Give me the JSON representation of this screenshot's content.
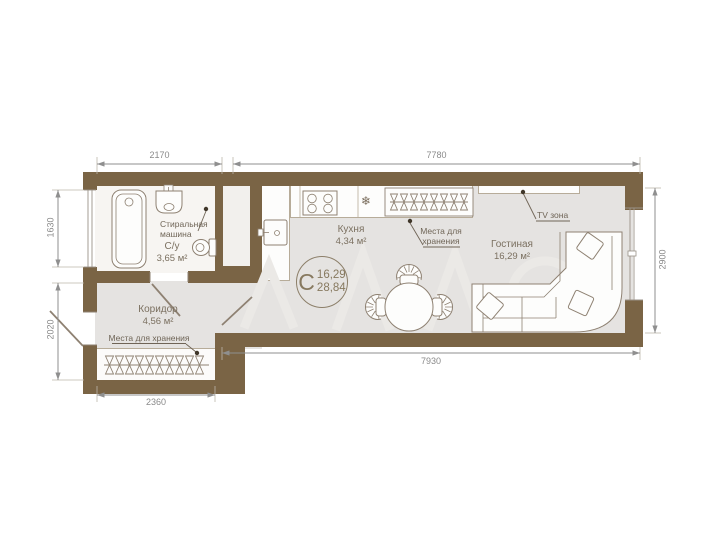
{
  "plan": {
    "badge": {
      "letter": "С",
      "area_top": "16,29",
      "area_bottom": "28,84"
    },
    "rooms": {
      "bathroom": {
        "name": "С/у",
        "area": "3,65 м²"
      },
      "washing_machine_label": "Стиральная машина",
      "kitchen": {
        "name": "Кухня",
        "area": "4,34 м²"
      },
      "kitchen_storage_label": "Места для хранения",
      "living": {
        "name": "Гостиная",
        "area": "16,29 м²"
      },
      "tv_zone_label": "TV зона",
      "corridor": {
        "name": "Коридор",
        "area": "4,56 м²"
      },
      "corridor_storage_label": "Места для хранения"
    },
    "dimensions": {
      "top_left": "2170",
      "top_right": "7780",
      "left_upper": "1630",
      "left_lower": "2020",
      "right_side": "2900",
      "bottom_main": "7930",
      "bottom_left": "2360"
    },
    "icons": {
      "fridge_icon": "❄"
    },
    "colors": {
      "wall": "#7a6445",
      "floor": "#e5e3e1",
      "outline": "#8e8172",
      "dimension": "#8a8a8a"
    }
  }
}
